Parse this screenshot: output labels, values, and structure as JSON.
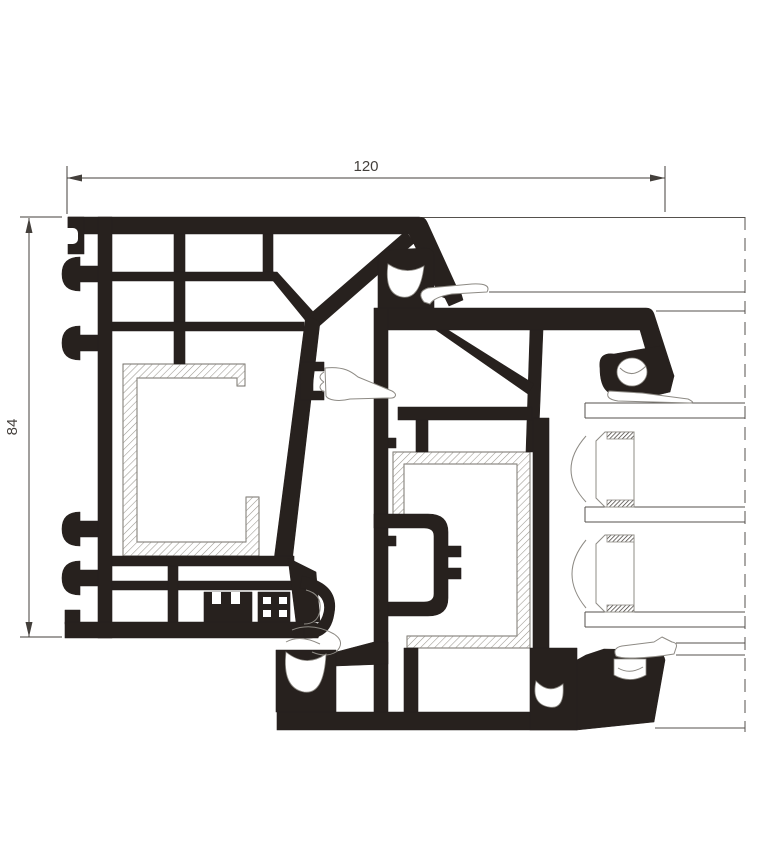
{
  "drawing": {
    "dimension_width": {
      "label": "120"
    },
    "dimension_height": {
      "label": "84"
    }
  },
  "colors": {
    "background": "#ffffff",
    "profile_ink": "#27211e",
    "dimension_line": "#433f3b",
    "thin_line": "#55514d",
    "gasket_line": "#8d8a84",
    "steel_outline": "#8f8c86",
    "steel_hatch": "#9b9890",
    "spacer_hatch": "#3a3531"
  }
}
